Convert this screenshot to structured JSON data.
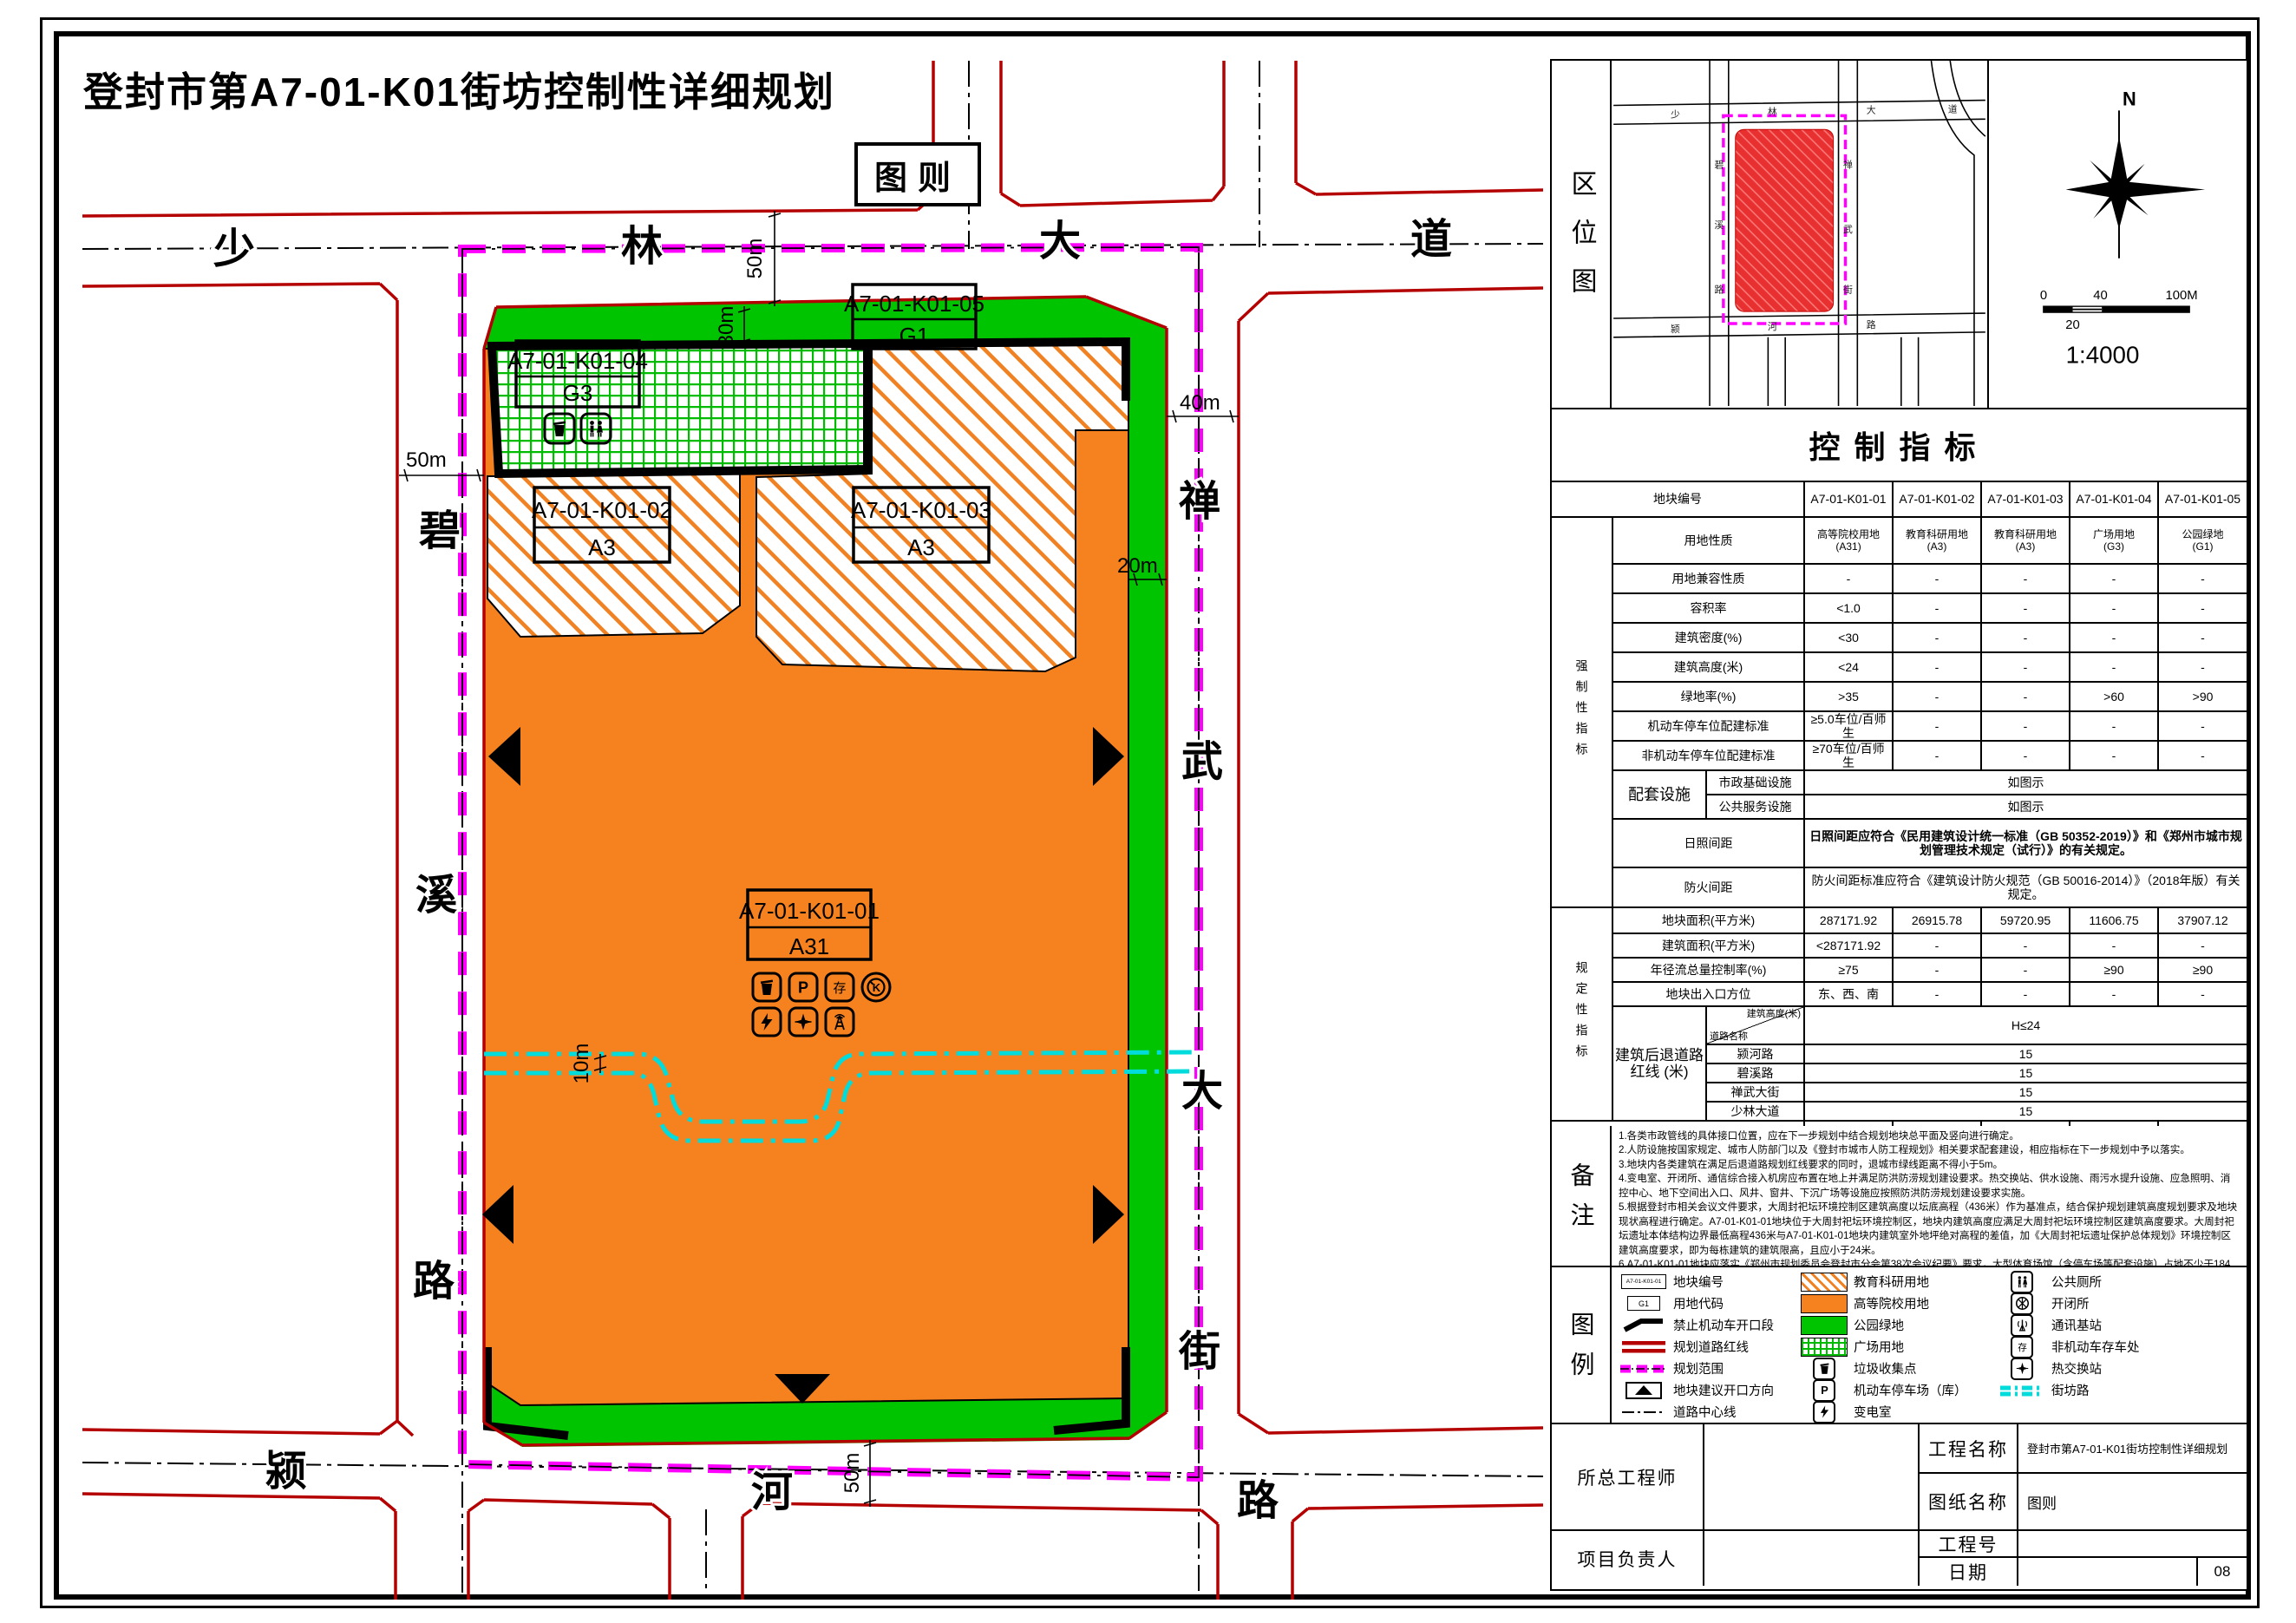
{
  "page": {
    "title": "登封市第A7-01-K01街坊控制性详细规划",
    "sheet_tag": "图则",
    "page_number": "08"
  },
  "colors": {
    "university_orange": "#F5821E",
    "park_green": "#00C400",
    "road_red_line": "#B40000",
    "planning_boundary_magenta": "#FF00FF",
    "block_road_cyan": "#00DCDC",
    "location_block_red": "#E93030"
  },
  "map": {
    "roads": {
      "north": [
        "少",
        "林",
        "大",
        "道"
      ],
      "west": [
        "碧",
        "溪",
        "路"
      ],
      "east": [
        "禅",
        "武",
        "大",
        "街"
      ],
      "south": [
        "颍",
        "河",
        "路"
      ]
    },
    "dims": {
      "top50": "50m",
      "top30": "30m",
      "west50": "50m",
      "east40": "40m",
      "east20": "20m",
      "south50": "50m",
      "mid10": "10m"
    },
    "plots": {
      "p01": {
        "code": "A7-01-K01-01",
        "use": "A31"
      },
      "p02": {
        "code": "A7-01-K01-02",
        "use": "A3"
      },
      "p03": {
        "code": "A7-01-K01-03",
        "use": "A3"
      },
      "p04": {
        "code": "A7-01-K01-04",
        "use": "G3"
      },
      "p05": {
        "code": "A7-01-K01-05",
        "use": "G1"
      }
    }
  },
  "loc": {
    "label": "区位图",
    "north_letter": "N",
    "ratio": "1:4000",
    "bar0": "0",
    "bar40": "40",
    "bar100": "100M",
    "bar20": "20",
    "roads": {
      "north": [
        "少",
        "林",
        "大",
        "道"
      ],
      "west": [
        "碧",
        "溪",
        "路"
      ],
      "east": [
        "禅",
        "武",
        "街"
      ],
      "south": [
        "颍",
        "河",
        "路"
      ]
    }
  },
  "ind": {
    "title": "控制指标",
    "header_label": "地块编号",
    "codes": [
      "A7-01-K01-01",
      "A7-01-K01-02",
      "A7-01-K01-03",
      "A7-01-K01-04",
      "A7-01-K01-05"
    ],
    "group1": "强制性指标",
    "group2": "规定性指标",
    "rows": {
      "land_use": {
        "label": "用地性质",
        "names": [
          "高等院校用地",
          "教育科研用地",
          "教育科研用地",
          "广场用地",
          "公园绿地"
        ],
        "codes": [
          "(A31)",
          "(A3)",
          "(A3)",
          "(G3)",
          "(G1)"
        ]
      },
      "compat": {
        "label": "用地兼容性质",
        "values": [
          "-",
          "-",
          "-",
          "-",
          "-"
        ]
      },
      "far": {
        "label": "容积率",
        "values": [
          "<1.0",
          "-",
          "-",
          "-",
          "-"
        ]
      },
      "density": {
        "label": "建筑密度(%)",
        "values": [
          "<30",
          "-",
          "-",
          "-",
          "-"
        ]
      },
      "height": {
        "label": "建筑高度(米)",
        "values": [
          "<24",
          "-",
          "-",
          "-",
          "-"
        ]
      },
      "green": {
        "label": "绿地率(%)",
        "values": [
          ">35",
          "-",
          "-",
          ">60",
          ">90"
        ]
      },
      "parking": {
        "label": "机动车停车位配建标准",
        "values": [
          "≥5.0车位/百师生",
          "-",
          "-",
          "-",
          "-"
        ]
      },
      "bike": {
        "label": "非机动车停车位配建标准",
        "values": [
          "≥70车位/百师生",
          "-",
          "-",
          "-",
          "-"
        ]
      },
      "facilities": {
        "label": "配套设施",
        "sub1": "市政基础设施",
        "sub2": "公共服务设施",
        "value1": "如图示",
        "value2": "如图示"
      },
      "sunlight": {
        "label": "日照间距",
        "value": "日照间距应符合《民用建筑设计统一标准（GB 50352-2019）》和《郑州市城市规划管理技术规定（试行）》的有关规定。"
      },
      "fire": {
        "label": "防火间距",
        "value": "防火间距标准应符合《建筑设计防火规范（GB 50016-2014）》（2018年版）有关规定。"
      },
      "area": {
        "label": "地块面积(平方米)",
        "values": [
          "287171.92",
          "26915.78",
          "59720.95",
          "11606.75",
          "37907.12"
        ]
      },
      "floor_area": {
        "label": "建筑面积(平方米)",
        "values": [
          "<287171.92",
          "-",
          "-",
          "-",
          "-"
        ]
      },
      "runoff": {
        "label": "年径流总量控制率(%)",
        "values": [
          "≥75",
          "-",
          "-",
          "≥90",
          "≥90"
        ]
      },
      "access": {
        "label": "地块出入口方位",
        "values": [
          "东、西、南",
          "-",
          "-",
          "-",
          "-"
        ]
      },
      "setback": {
        "label": "建筑后退道路红线 (米)",
        "corner_top": "建筑高度(米)",
        "corner_bottom": "道路名称",
        "height_value": "H≤24",
        "roads": [
          {
            "name": "颍河路",
            "value": "15"
          },
          {
            "name": "碧溪路",
            "value": "15"
          },
          {
            "name": "禅武大街",
            "value": "15"
          },
          {
            "name": "少林大道",
            "value": "15"
          }
        ]
      },
      "population": {
        "label": "人口容量(人)",
        "values": [
          "-",
          "-",
          "-",
          "-",
          "-"
        ]
      }
    }
  },
  "notes": {
    "label": "备注",
    "items": [
      "1.各类市政管线的具体接口位置，应在下一步规划中结合规划地块总平面及竖向进行确定。",
      "2.人防设施按国家规定、城市人防部门以及《登封市城市人防工程规划》相关要求配套建设，相应指标在下一步规划中予以落实。",
      "3.地块内各类建筑在满足后退道路规划红线要求的同时，退城市绿线距离不得小于5m。",
      "4.变电室、开闭所、通信综合接入机房应布置在地上并满足防洪防涝规划建设要求。热交换站、供水设施、雨污水提升设施、应急照明、消控中心、地下空间出入口、风井、窗井、下沉广场等设施应按照防洪防涝规划建设要求实施。",
      "5.根据登封市相关会议文件要求，大周封祀坛环境控制区建筑高度以坛底高程（436米）作为基准点，结合保护规划建筑高度规划要求及地块现状高程进行确定。A7-01-K01-01地块位于大周封祀坛环境控制区，地块内建筑高度应满足大周封祀坛环境控制区建筑高度要求。大周封祀坛遗址本体结构边界最低高程436米与A7-01-K01-01地块内建筑室外地坪绝对高程的差值，加《大周封祀坛遗址保护总体规划》环境控制区建筑高度要求，即为每栋建筑的建筑限高，且应小于24米。",
      "6.A7-01-K01-01地块应落实《郑州市规划委员会登封市分会第38次会议纪要》要求，大型体育场馆（含停车场等配套设施）占地不少于184亩；大型体育场馆包含15000座室外体育场、3000座室内体育馆、标准泳道游泳馆各一座，体育场馆建筑面积应满足对应座位数使用要求；大型体育场馆建成后应对社会公众开放。"
    ]
  },
  "legend": {
    "label": "图例",
    "samples": {
      "plot_code": "A7-01-K01-01",
      "use_code": "G1"
    },
    "col1": [
      "地块编号",
      "用地代码",
      "禁止机动车开口段",
      "规划道路红线",
      "规划范围",
      "地块建议开口方向",
      "道路中心线"
    ],
    "col2": [
      "教育科研用地",
      "高等院校用地",
      "公园绿地",
      "广场用地",
      "垃圾收集点",
      "机动车停车场（库）",
      "变电室"
    ],
    "col3": [
      "公共厕所",
      "开闭所",
      "通讯基站",
      "非机动车存车处",
      "热交换站",
      "街坊路"
    ]
  },
  "tb": {
    "chief": "所总工程师",
    "pm": "项目负责人",
    "project_label": "工程名称",
    "project_value": "登封市第A7-01-K01街坊控制性详细规划",
    "sheet_label": "图纸名称",
    "sheet_value": "图则",
    "number_label": "工程号",
    "date_label": "日期"
  }
}
